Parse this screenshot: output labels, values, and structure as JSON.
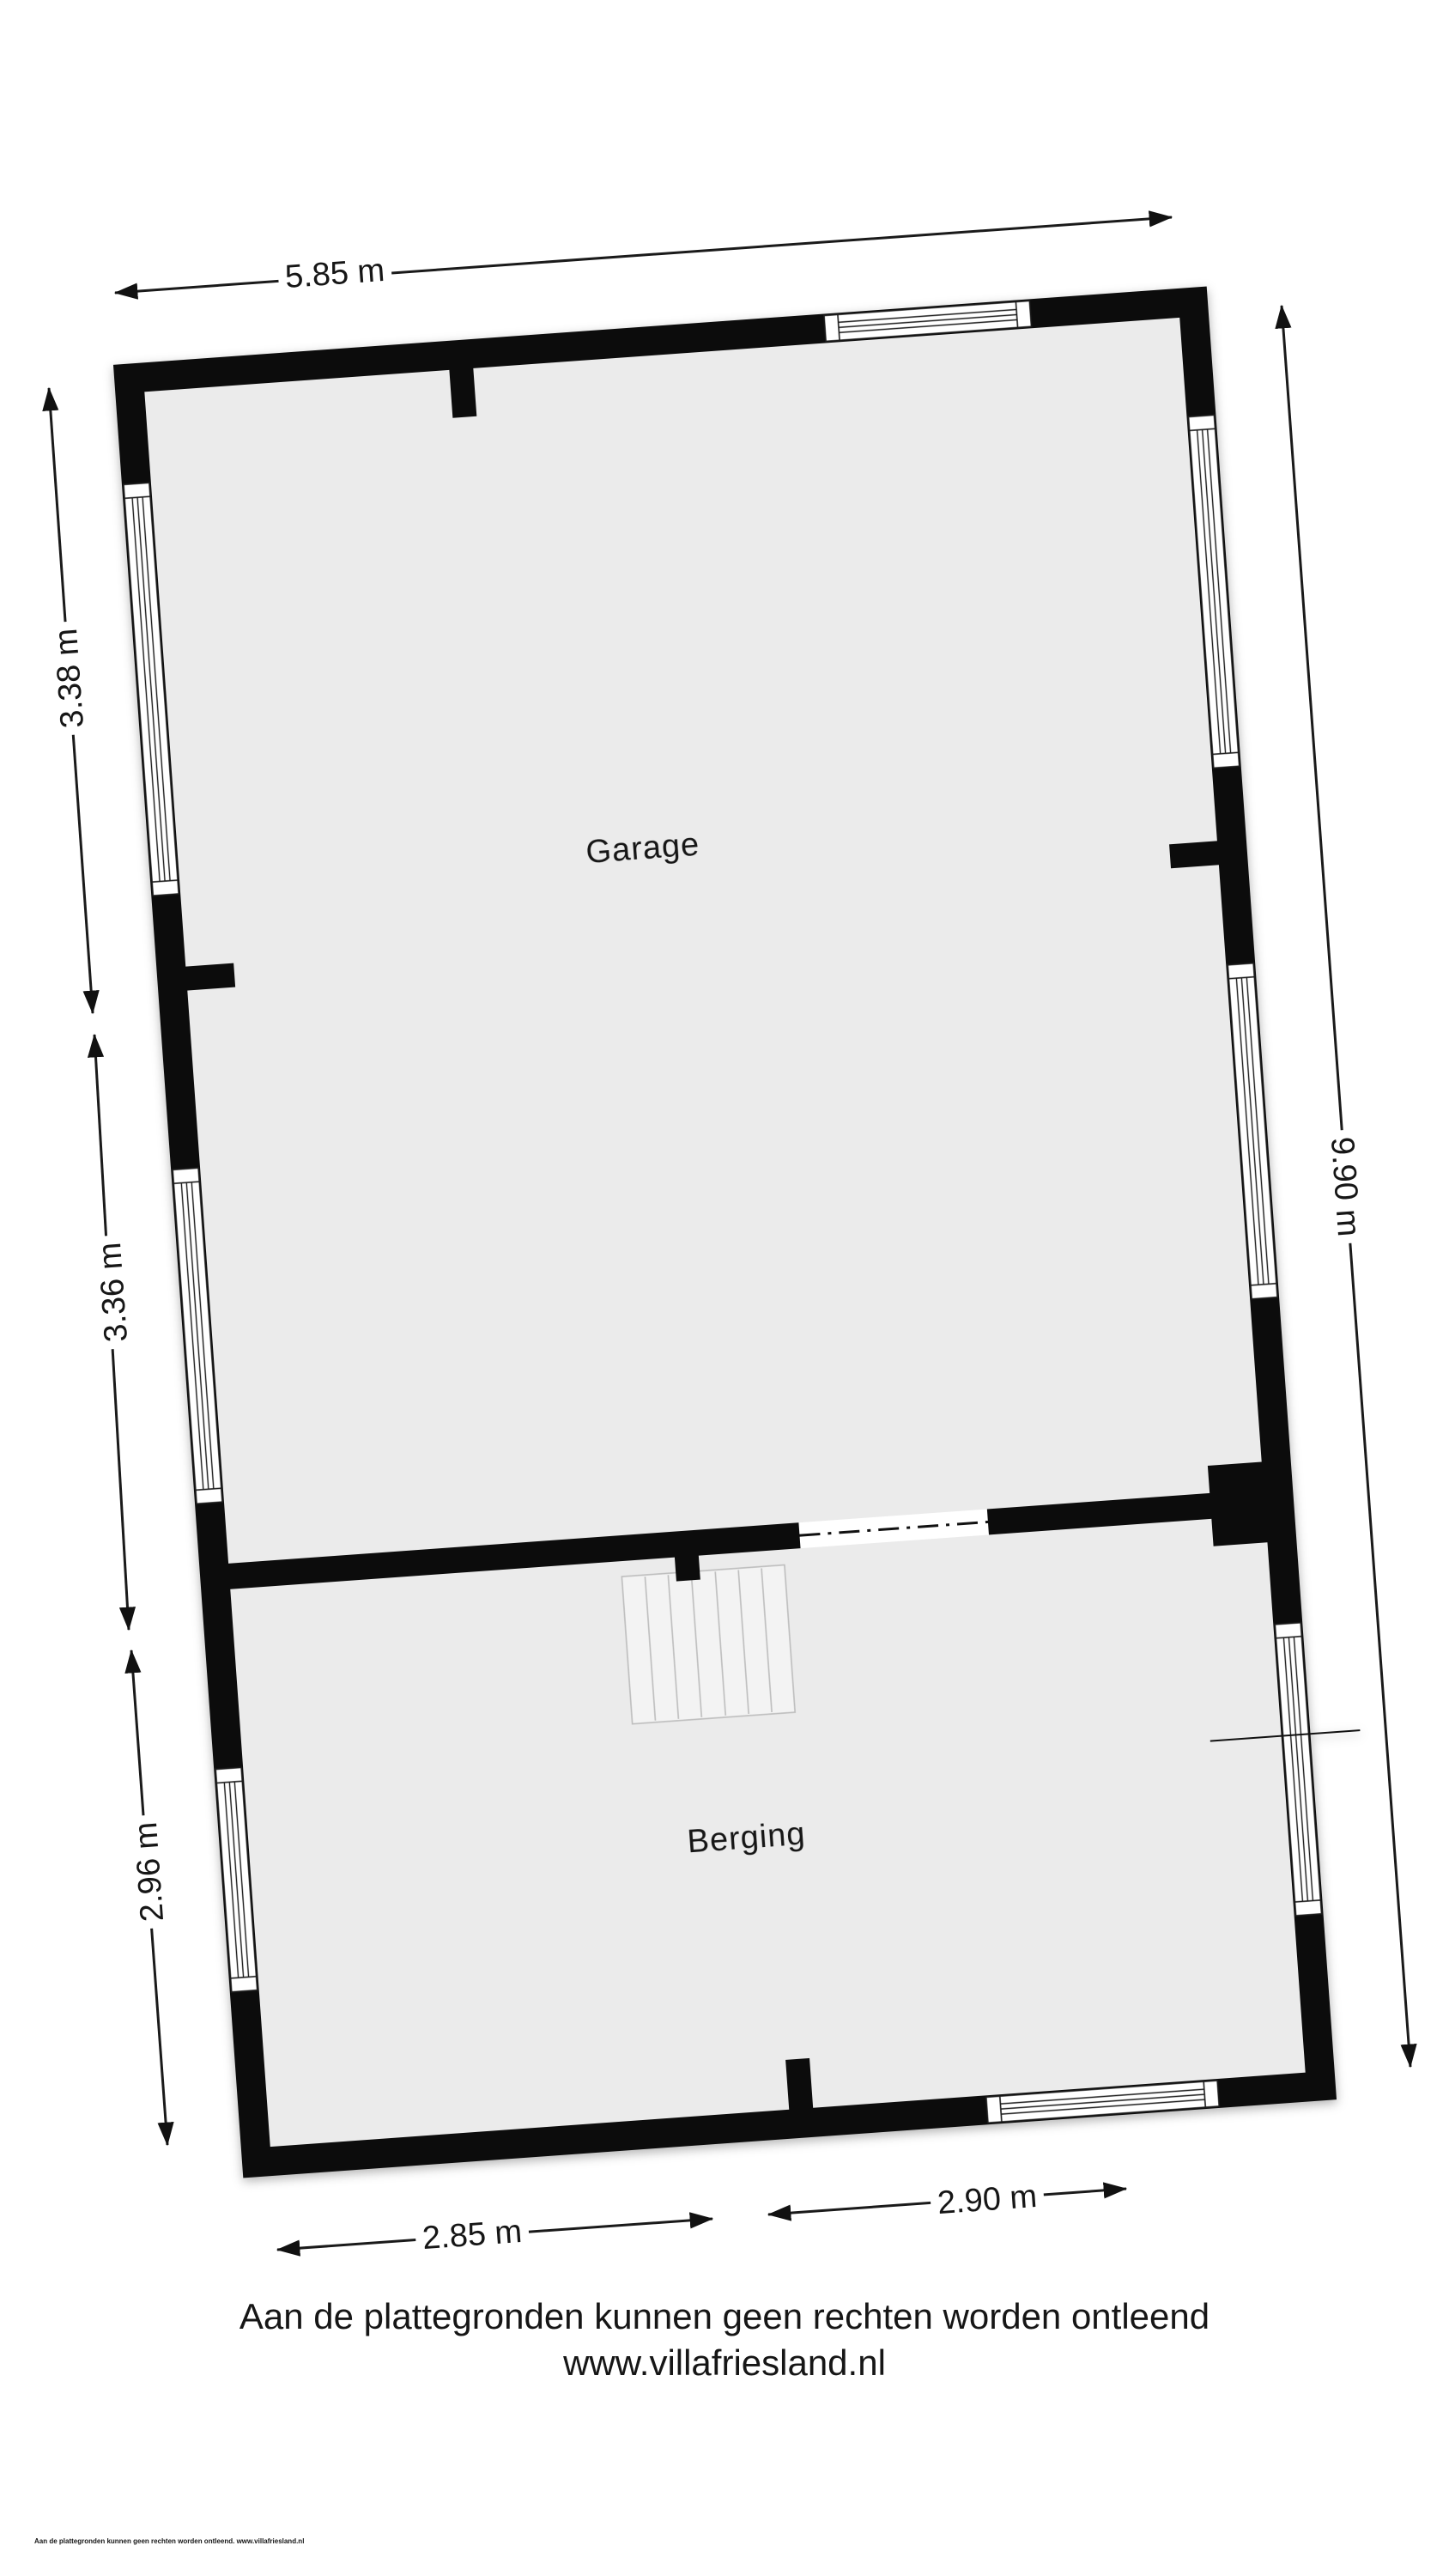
{
  "floorplan": {
    "rooms": {
      "garage": "Garage",
      "berging": "Berging"
    },
    "dims": {
      "top": "5.85 m",
      "right": "9.90 m",
      "left1": "3.38 m",
      "left2": "3.36 m",
      "left3": "2.96 m",
      "bottom1": "2.85 m",
      "bottom2": "2.90 m"
    },
    "colors": {
      "wall": "#0c0c0c",
      "floor": "#ebebeb",
      "windowline": "#1c1c1c",
      "dimline": "#1a1a1a",
      "stairfill": "#f3f3f3",
      "stairline": "#bdbdbd"
    }
  },
  "footer": {
    "line1": "Aan de plattegronden kunnen geen rechten worden ontleend",
    "line2": "www.villafriesland.nl"
  },
  "fineprint": "Aan de plattegronden kunnen geen rechten worden ontleend. www.villafriesland.nl"
}
